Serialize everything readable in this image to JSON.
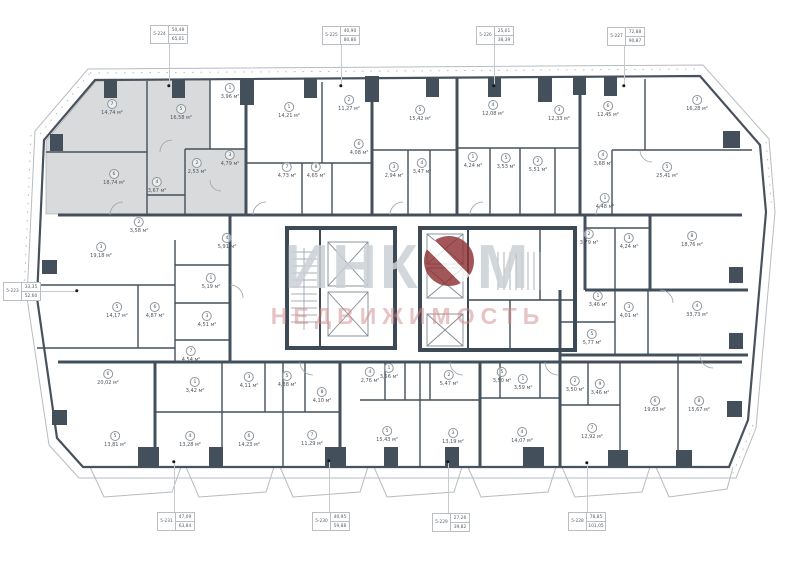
{
  "watermark": {
    "part1": "ИНК",
    "o": "О",
    "part2": "М",
    "line2": "НЕДВИЖИМОСТЬ"
  },
  "colors": {
    "wall": "#43505c",
    "highlighted_unit_fill": "#d9dadb",
    "balcony_line": "#b6bcc2",
    "watermark_text": "#cad0d5",
    "watermark_accent": "#8d3134",
    "watermark_sub": "#d08888",
    "leader_dot": "#161616"
  },
  "unit_labels": [
    {
      "id": "5-224",
      "living_area": "50,48",
      "total_area": "65,01",
      "box": {
        "x": 150,
        "y": 25
      },
      "dot": {
        "x": 169,
        "y": 86
      },
      "side": "top"
    },
    {
      "id": "5-225",
      "living_area": "40,90",
      "total_area": "80,86",
      "box": {
        "x": 322,
        "y": 26
      },
      "dot": {
        "x": 341,
        "y": 86
      },
      "side": "top"
    },
    {
      "id": "5-226",
      "living_area": "25,01",
      "total_area": "38,39",
      "box": {
        "x": 476,
        "y": 26
      },
      "dot": {
        "x": 494,
        "y": 86
      },
      "side": "top"
    },
    {
      "id": "5-227",
      "living_area": "72,88",
      "total_area": "90,87",
      "box": {
        "x": 607,
        "y": 27
      },
      "dot": {
        "x": 624,
        "y": 86
      },
      "side": "top"
    },
    {
      "id": "5-223",
      "living_area": "33,35",
      "total_area": "52,60",
      "box": {
        "x": 3,
        "y": 282
      },
      "dot": {
        "x": 77,
        "y": 291
      },
      "side": "left"
    },
    {
      "id": "5-231",
      "living_area": "47,09",
      "total_area": "63,84",
      "box": {
        "x": 157,
        "y": 512
      },
      "dot": {
        "x": 174,
        "y": 462
      },
      "side": "bottom"
    },
    {
      "id": "5-230",
      "living_area": "40,95",
      "total_area": "59,88",
      "box": {
        "x": 312,
        "y": 512
      },
      "dot": {
        "x": 329,
        "y": 461
      },
      "side": "bottom"
    },
    {
      "id": "5-229",
      "living_area": "27,26",
      "total_area": "39,82",
      "box": {
        "x": 432,
        "y": 513
      },
      "dot": {
        "x": 448,
        "y": 462
      },
      "side": "bottom"
    },
    {
      "id": "5-228",
      "living_area": "78,85",
      "total_area": "101,05",
      "box": {
        "x": 568,
        "y": 512
      },
      "dot": {
        "x": 587,
        "y": 463
      },
      "side": "bottom"
    }
  ],
  "room_labels": [
    {
      "n": "7",
      "a": "14,74 м²",
      "x": 112,
      "y": 104
    },
    {
      "n": "5",
      "a": "16,58 м²",
      "x": 181,
      "y": 109
    },
    {
      "n": "1",
      "a": "3,96 м²",
      "x": 230,
      "y": 88
    },
    {
      "n": "6",
      "a": "18,74 м²",
      "x": 114,
      "y": 174
    },
    {
      "n": "2",
      "a": "2,53 м²",
      "x": 197,
      "y": 163
    },
    {
      "n": "3",
      "a": "4,79 м²",
      "x": 230,
      "y": 155
    },
    {
      "n": "4",
      "a": "3,67 м²",
      "x": 157,
      "y": 182
    },
    {
      "n": "1",
      "a": "14,21 м²",
      "x": 289,
      "y": 107
    },
    {
      "n": "2",
      "a": "11,27 м²",
      "x": 349,
      "y": 100
    },
    {
      "n": "6",
      "a": "4,08 м²",
      "x": 359,
      "y": 144
    },
    {
      "n": "7",
      "a": "4,73 м²",
      "x": 287,
      "y": 167
    },
    {
      "n": "8",
      "a": "4,65 м²",
      "x": 316,
      "y": 167
    },
    {
      "n": "3",
      "a": "2,94 м²",
      "x": 394,
      "y": 167
    },
    {
      "n": "5",
      "a": "15,42 м²",
      "x": 420,
      "y": 110
    },
    {
      "n": "4",
      "a": "12,08 м²",
      "x": 493,
      "y": 105
    },
    {
      "n": "3",
      "a": "12,33 м²",
      "x": 559,
      "y": 110
    },
    {
      "n": "4",
      "a": "3,47 м²",
      "x": 422,
      "y": 163
    },
    {
      "n": "1",
      "a": "4,24 м²",
      "x": 473,
      "y": 157
    },
    {
      "n": "5",
      "a": "3,53 м²",
      "x": 506,
      "y": 158
    },
    {
      "n": "2",
      "a": "5,51 м²",
      "x": 538,
      "y": 161
    },
    {
      "n": "6",
      "a": "12,45 м²",
      "x": 608,
      "y": 106
    },
    {
      "n": "7",
      "a": "16,28 м²",
      "x": 697,
      "y": 100
    },
    {
      "n": "5",
      "a": "25,41 м²",
      "x": 667,
      "y": 167
    },
    {
      "n": "4",
      "a": "3,68 м²",
      "x": 603,
      "y": 155
    },
    {
      "n": "1",
      "a": "4,48 м²",
      "x": 605,
      "y": 198
    },
    {
      "n": "2",
      "a": "3,79 м²",
      "x": 589,
      "y": 234
    },
    {
      "n": "3",
      "a": "4,24 м²",
      "x": 629,
      "y": 238
    },
    {
      "n": "8",
      "a": "18,76 м²",
      "x": 692,
      "y": 236
    },
    {
      "n": "1",
      "a": "3,46 м²",
      "x": 598,
      "y": 296
    },
    {
      "n": "3",
      "a": "4,01 м²",
      "x": 629,
      "y": 307
    },
    {
      "n": "4",
      "a": "33,73 м²",
      "x": 697,
      "y": 306
    },
    {
      "n": "5",
      "a": "5,77 м²",
      "x": 592,
      "y": 334
    },
    {
      "n": "2",
      "a": "3,50 м²",
      "x": 575,
      "y": 381
    },
    {
      "n": "9",
      "a": "3,46 м²",
      "x": 600,
      "y": 384
    },
    {
      "n": "6",
      "a": "19,63 м²",
      "x": 655,
      "y": 401
    },
    {
      "n": "8",
      "a": "15,67 м²",
      "x": 699,
      "y": 401
    },
    {
      "n": "7",
      "a": "12,92 м²",
      "x": 592,
      "y": 428
    },
    {
      "n": "2",
      "a": "3,58 м²",
      "x": 139,
      "y": 222
    },
    {
      "n": "3",
      "a": "19,18 м²",
      "x": 101,
      "y": 247
    },
    {
      "n": "5",
      "a": "14,17 м²",
      "x": 117,
      "y": 307
    },
    {
      "n": "6",
      "a": "4,87 м²",
      "x": 155,
      "y": 307
    },
    {
      "n": "4",
      "a": "5,91 м²",
      "x": 227,
      "y": 238
    },
    {
      "n": "1",
      "a": "5,19 м²",
      "x": 211,
      "y": 278
    },
    {
      "n": "3",
      "a": "4,51 м²",
      "x": 207,
      "y": 316
    },
    {
      "n": "7",
      "a": "4,54 м²",
      "x": 191,
      "y": 351
    },
    {
      "n": "1",
      "a": "3,42 м²",
      "x": 195,
      "y": 382
    },
    {
      "n": "6",
      "a": "20,02 м²",
      "x": 108,
      "y": 374
    },
    {
      "n": "5",
      "a": "13,81 м²",
      "x": 115,
      "y": 436
    },
    {
      "n": "4",
      "a": "13,28 м²",
      "x": 190,
      "y": 436
    },
    {
      "n": "6",
      "a": "14,23 м²",
      "x": 249,
      "y": 436
    },
    {
      "n": "7",
      "a": "11,29 м²",
      "x": 312,
      "y": 435
    },
    {
      "n": "3",
      "a": "4,11 м²",
      "x": 249,
      "y": 377
    },
    {
      "n": "5",
      "a": "4,38 м²",
      "x": 287,
      "y": 376
    },
    {
      "n": "8",
      "a": "4,10 м²",
      "x": 322,
      "y": 392
    },
    {
      "n": "4",
      "a": "2,76 м²",
      "x": 370,
      "y": 372
    },
    {
      "n": "1",
      "a": "3,56 м²",
      "x": 389,
      "y": 368
    },
    {
      "n": "2",
      "a": "5,47 м²",
      "x": 449,
      "y": 375
    },
    {
      "n": "5",
      "a": "15,43 м²",
      "x": 387,
      "y": 431
    },
    {
      "n": "3",
      "a": "13,19 м²",
      "x": 453,
      "y": 433
    },
    {
      "n": "5",
      "a": "3,50 м²",
      "x": 502,
      "y": 372
    },
    {
      "n": "1",
      "a": "3,59 м²",
      "x": 523,
      "y": 379
    },
    {
      "n": "4",
      "a": "14,07 м²",
      "x": 522,
      "y": 432
    }
  ]
}
